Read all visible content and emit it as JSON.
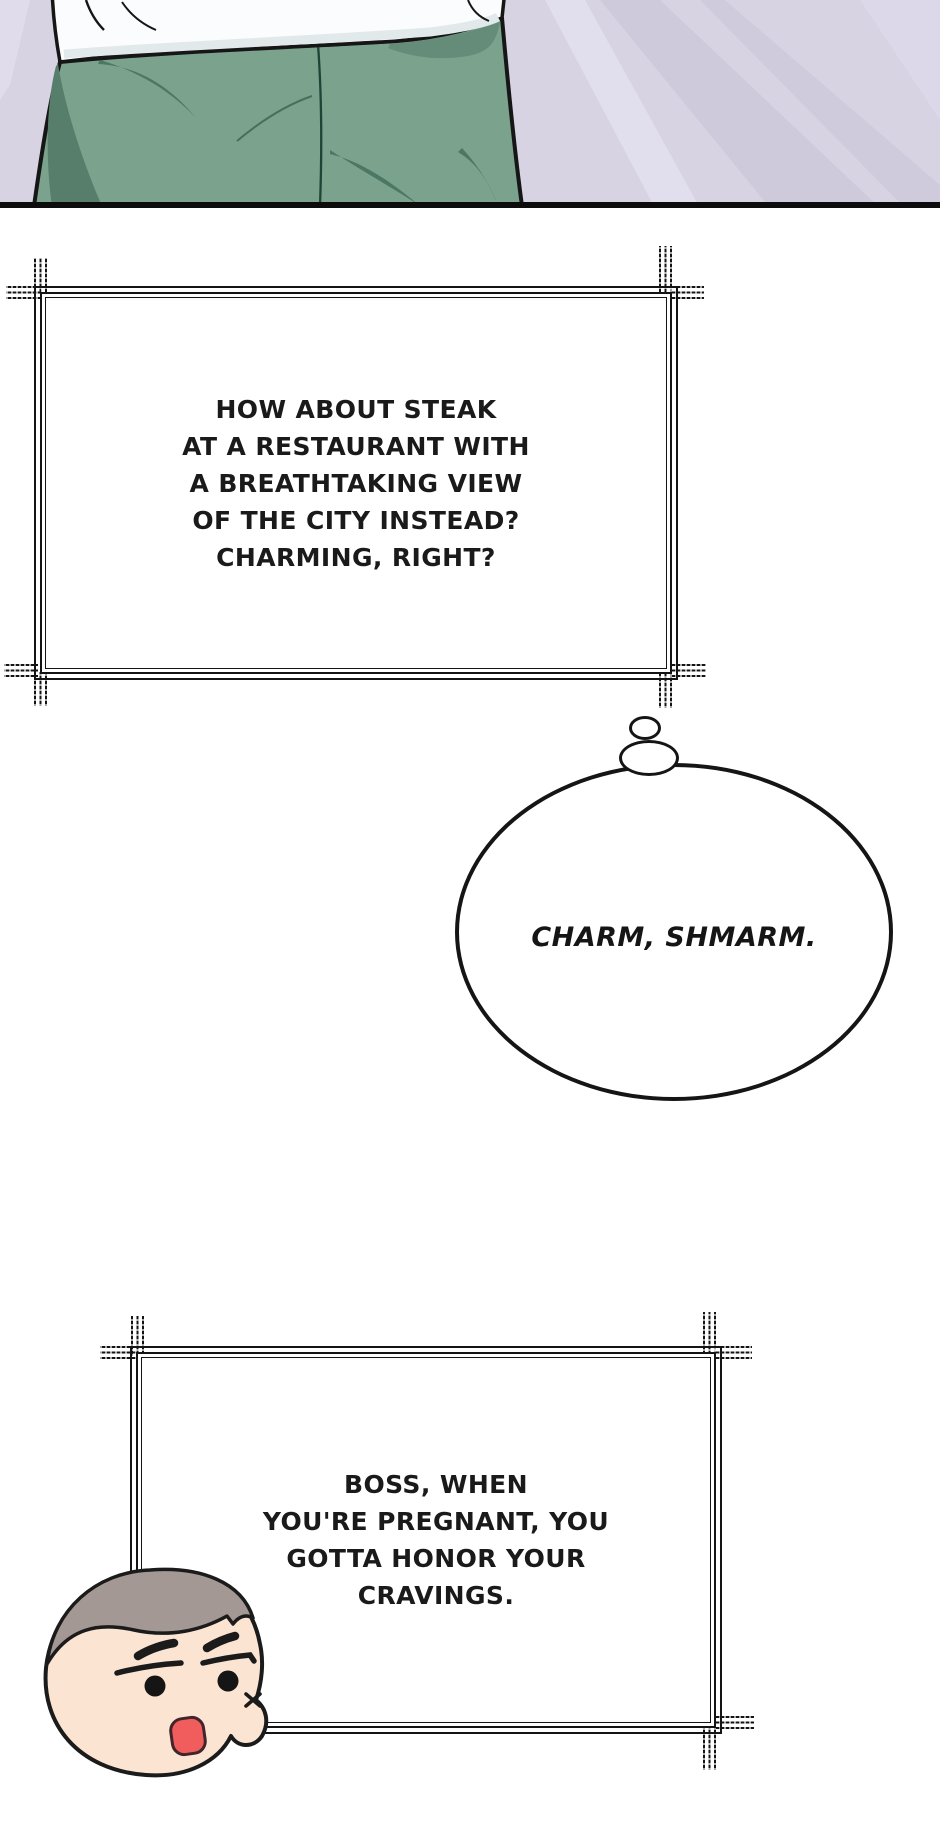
{
  "panel": {
    "kind": "comic-illustration",
    "colors": {
      "background_lavender": "#d8d3e3",
      "shirt_white": "#fbfcfd",
      "pants_green": "#7ba28c",
      "pants_shadow": "#4c7765",
      "bottom_border": "#0c0c0c"
    }
  },
  "speech_box_1": {
    "lines": [
      "HOW ABOUT STEAK",
      "AT A RESTAURANT WITH",
      "A BREATHTAKING VIEW",
      "OF THE CITY INSTEAD?",
      "CHARMING, RIGHT?"
    ]
  },
  "thought_bubble": {
    "text": "CHARM, SHMARM."
  },
  "speech_box_2": {
    "lines": [
      "BOSS, WHEN",
      "YOU'RE PREGNANT, YOU",
      "GOTTA HONOR YOUR",
      "CRAVINGS."
    ]
  },
  "chibi": {
    "colors": {
      "hair": "#a49894",
      "skin": "#fce4d2",
      "mouth": "#f15c5c",
      "ink": "#1b1b1b"
    }
  },
  "ink_color": "#141414"
}
